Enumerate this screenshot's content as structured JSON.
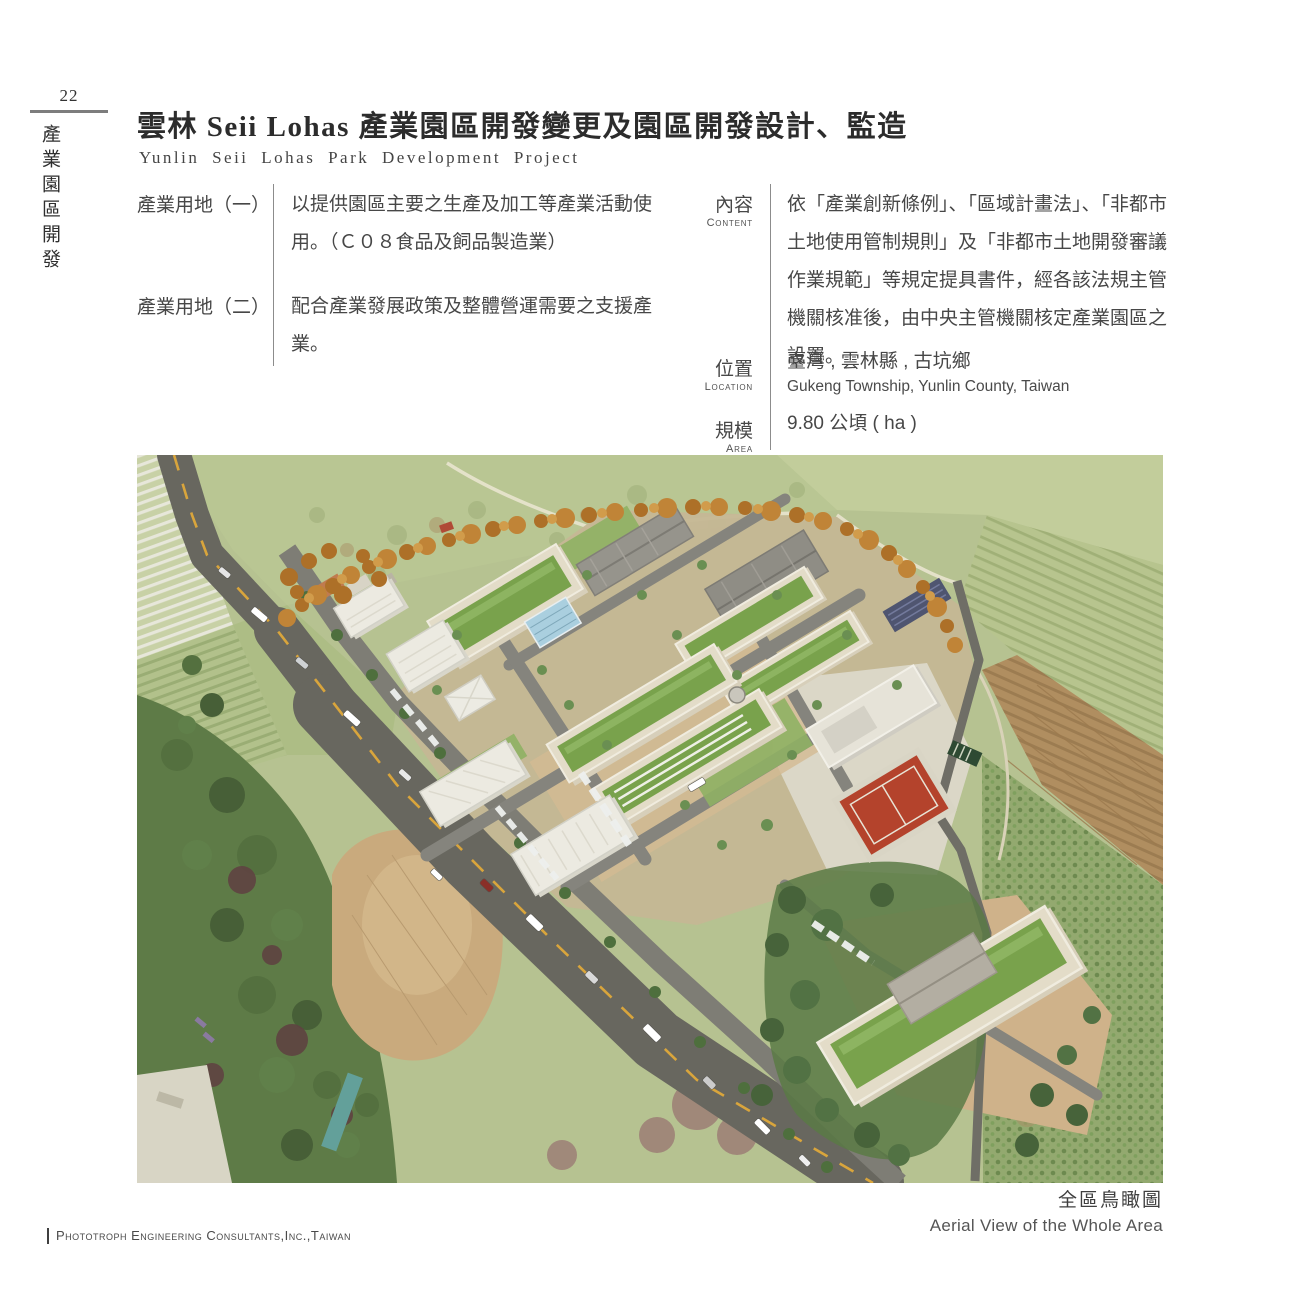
{
  "page": {
    "number": "22",
    "side_label": "產業園區開發",
    "footer": "Phototroph Engineering Consultants,Inc.,Taiwan"
  },
  "header": {
    "title_zh": "雲林 Seii Lohas 產業園區開發變更及園區開發設計、監造",
    "title_en": "Yunlin Seii Lohas Park Development Project"
  },
  "land_use": [
    {
      "label": "產業用地（一）",
      "desc": "以提供園區主要之生產及加工等產業活動使用。（Ｃ０８食品及飼品製造業）"
    },
    {
      "label": "產業用地（二）",
      "desc": "配合產業發展政策及整體營運需要之支援產業。"
    }
  ],
  "details": {
    "content": {
      "label_zh": "內容",
      "label_en": "Content",
      "text": "依「產業創新條例」、「區域計畫法」、「非都市土地使用管制規則」及「非都市土地開發審議作業規範」等規定提具書件，經各該法規主管機關核准後，由中央主管機關核定產業園區之設置。"
    },
    "location": {
      "label_zh": "位置",
      "label_en": "Location",
      "text_zh": "臺灣 , 雲林縣 , 古坑鄉",
      "text_en": "Gukeng Township, Yunlin County, Taiwan"
    },
    "area": {
      "label_zh": "規模",
      "label_en": "Area",
      "text_zh": "9.80 公頃 ( ha )"
    }
  },
  "figure": {
    "caption_zh": "全區鳥瞰圖",
    "caption_en": "Aerial View of the Whole Area"
  },
  "colors": {
    "text": "#3d3d3d",
    "divider": "#8c8c8c",
    "road": "#68675f",
    "green_roof": "#79a24c"
  }
}
